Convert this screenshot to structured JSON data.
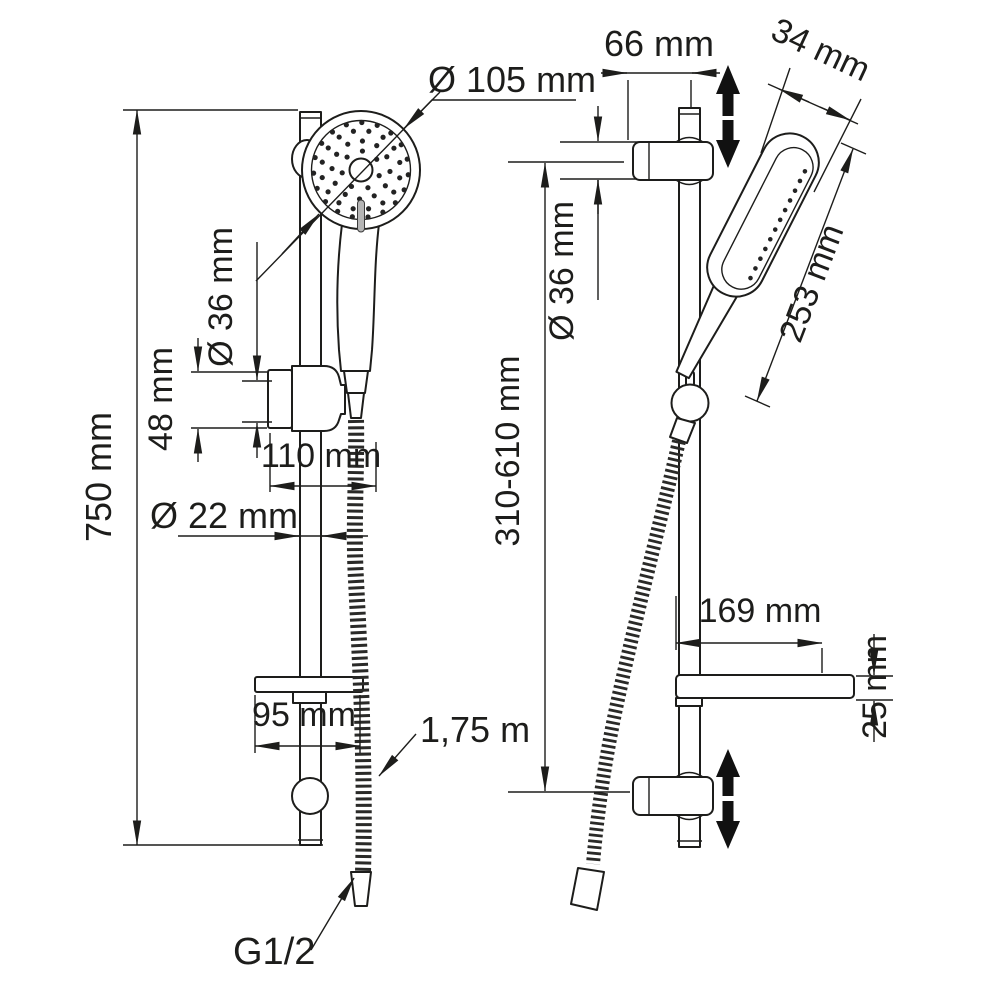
{
  "drawing": {
    "line_color": "#1d1d1b",
    "background": "#ffffff",
    "front_view": {
      "head_diameter": "Ø 105 mm",
      "total_height": "750 mm",
      "holder_diameter": "Ø 36 mm",
      "holder_height": "48 mm",
      "holder_width": "110 mm",
      "bar_diameter": "Ø 22 mm",
      "soap_dish_width": "95 mm",
      "hose_length": "1,75 m",
      "connection_thread": "G1/2"
    },
    "side_view": {
      "wall_offset": "66 mm",
      "handshower_width": "34 mm",
      "bracket_diameter": "Ø 36 mm",
      "handshower_length": "253 mm",
      "holder_adjust_range": "310-610 mm",
      "soap_dish_depth": "169 mm",
      "soap_dish_thickness": "25 mm"
    }
  }
}
